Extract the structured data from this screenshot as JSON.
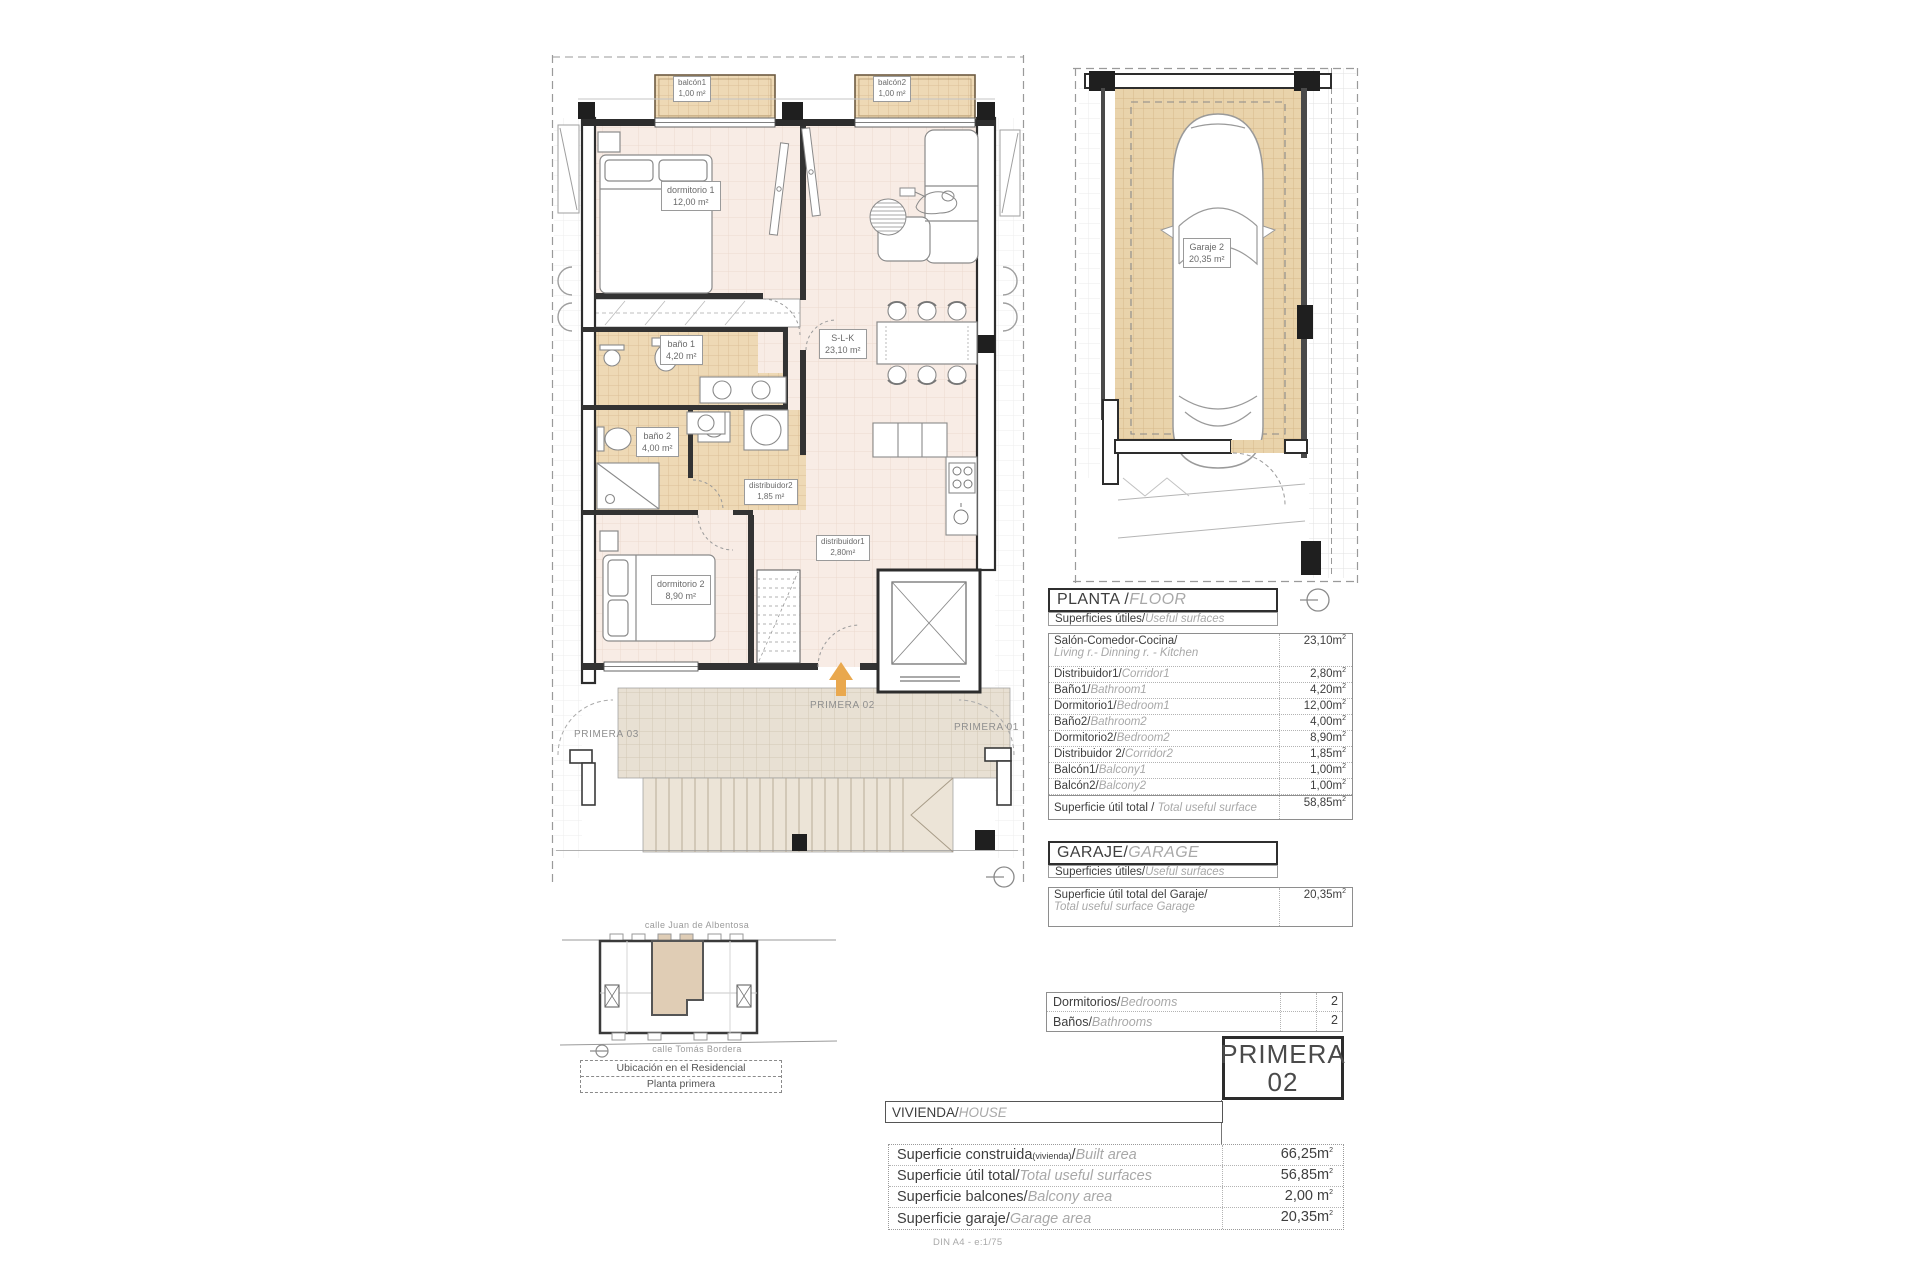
{
  "colors": {
    "accent_orange": "#e9a84e",
    "room_pink": "#f8ece5",
    "tile_tan": "#e9d3ab",
    "terrace_beige": "#e8e0d3",
    "wall": "#2d2d2d"
  },
  "icons": {
    "orientation": "circle-with-line",
    "entrance_arrow": "up-arrow"
  },
  "floor_plan": {
    "rooms": {
      "balcon1": {
        "name": "balcón1",
        "area": "1,00 m²"
      },
      "balcon2": {
        "name": "balcón2",
        "area": "1,00 m²"
      },
      "dormitorio1": {
        "name": "dormitorio 1",
        "area": "12,00 m²"
      },
      "bano1": {
        "name": "baño 1",
        "area": "4,20 m²"
      },
      "slk": {
        "name": "S-L-K",
        "area": "23,10 m²"
      },
      "bano2": {
        "name": "baño 2",
        "area": "4,00 m²"
      },
      "distribuidor2": {
        "name": "distribuidor2",
        "area": "1,85 m²"
      },
      "distribuidor1": {
        "name": "distribuidor1",
        "area": "2,80m²"
      },
      "dormitorio2": {
        "name": "dormitorio 2",
        "area": "8,90 m²"
      }
    },
    "unit_labels": {
      "current": "PRIMERA 02",
      "left": "PRIMERA 03",
      "right": "PRIMERA 01"
    }
  },
  "garage_plan": {
    "name": "Garaje 2",
    "area": "20,35 m²"
  },
  "planta_table": {
    "title_es": "PLANTA / ",
    "title_en": "FLOOR",
    "subtitle_es": "Superficies útiles/",
    "subtitle_en": "Useful surfaces",
    "rows": [
      {
        "es": "Salón-Comedor-Cocina/",
        "en": "Living r.- Dinning r. - Kitchen",
        "value": "23,10m",
        "sup": "2"
      },
      {
        "es": "Distribuidor1/",
        "en": "Corridor1",
        "value": "2,80m",
        "sup": "2"
      },
      {
        "es": "Baño1/",
        "en": "Bathroom1",
        "value": "4,20m",
        "sup": "2"
      },
      {
        "es": "Dormitorio1/",
        "en": "Bedroom1",
        "value": "12,00m",
        "sup": "2"
      },
      {
        "es": "Baño2/",
        "en": "Bathroom2",
        "value": "4,00m",
        "sup": "2"
      },
      {
        "es": "Dormitorio2/",
        "en": "Bedroom2",
        "value": "8,90m",
        "sup": "2"
      },
      {
        "es": "Distribuidor 2/",
        "en": "Corridor2",
        "value": "1,85m",
        "sup": "2"
      },
      {
        "es": "Balcón1/",
        "en": "Balcony1",
        "value": "1,00m",
        "sup": "2"
      },
      {
        "es": "Balcón2/",
        "en": "Balcony2",
        "value": "1,00m",
        "sup": "2"
      }
    ],
    "total": {
      "es": "Superficie útil total / ",
      "en": "Total useful surface",
      "value": "58,85m",
      "sup": "2"
    }
  },
  "garaje_table": {
    "title_es": "GARAJE/",
    "title_en": "GARAGE",
    "subtitle_es": "Superficies útiles/",
    "subtitle_en": "Useful surfaces",
    "row": {
      "es": "Superficie útil total del Garaje/",
      "en": "Total useful surface Garage",
      "value": "20,35m",
      "sup": "2"
    }
  },
  "counts": {
    "rows": [
      {
        "es": "Dormitorios/",
        "en": "Bedrooms",
        "value": "2"
      },
      {
        "es": "Baños/",
        "en": "Bathrooms",
        "value": "2"
      }
    ]
  },
  "primera_badge": {
    "line1": "PRIMERA",
    "line2": "02"
  },
  "vivienda_table": {
    "title_es": "VIVIENDA/",
    "title_en": "HOUSE",
    "rows": [
      {
        "es": "Superficie construida",
        "note": "(vivienda)",
        "sep": "/",
        "en": "Built area",
        "value": "66,25m",
        "sup": "2"
      },
      {
        "es": "Superficie útil total/",
        "en": "Total useful surfaces",
        "value": "56,85m",
        "sup": "2"
      },
      {
        "es": "Superficie balcones/",
        "en": "Balcony area",
        "value": "2,00 m",
        "sup": "2"
      },
      {
        "es": "Superficie garaje/",
        "en": "Garage area",
        "value": "20,35m",
        "sup": "2"
      }
    ]
  },
  "site_plan": {
    "street_top": "calle Juan de Albentosa",
    "street_bottom": "calle Tomás Bordera",
    "caption1": "Ubicación en el Residencial",
    "caption2": "Planta primera"
  },
  "footer": "DIN A4 - e:1/75"
}
